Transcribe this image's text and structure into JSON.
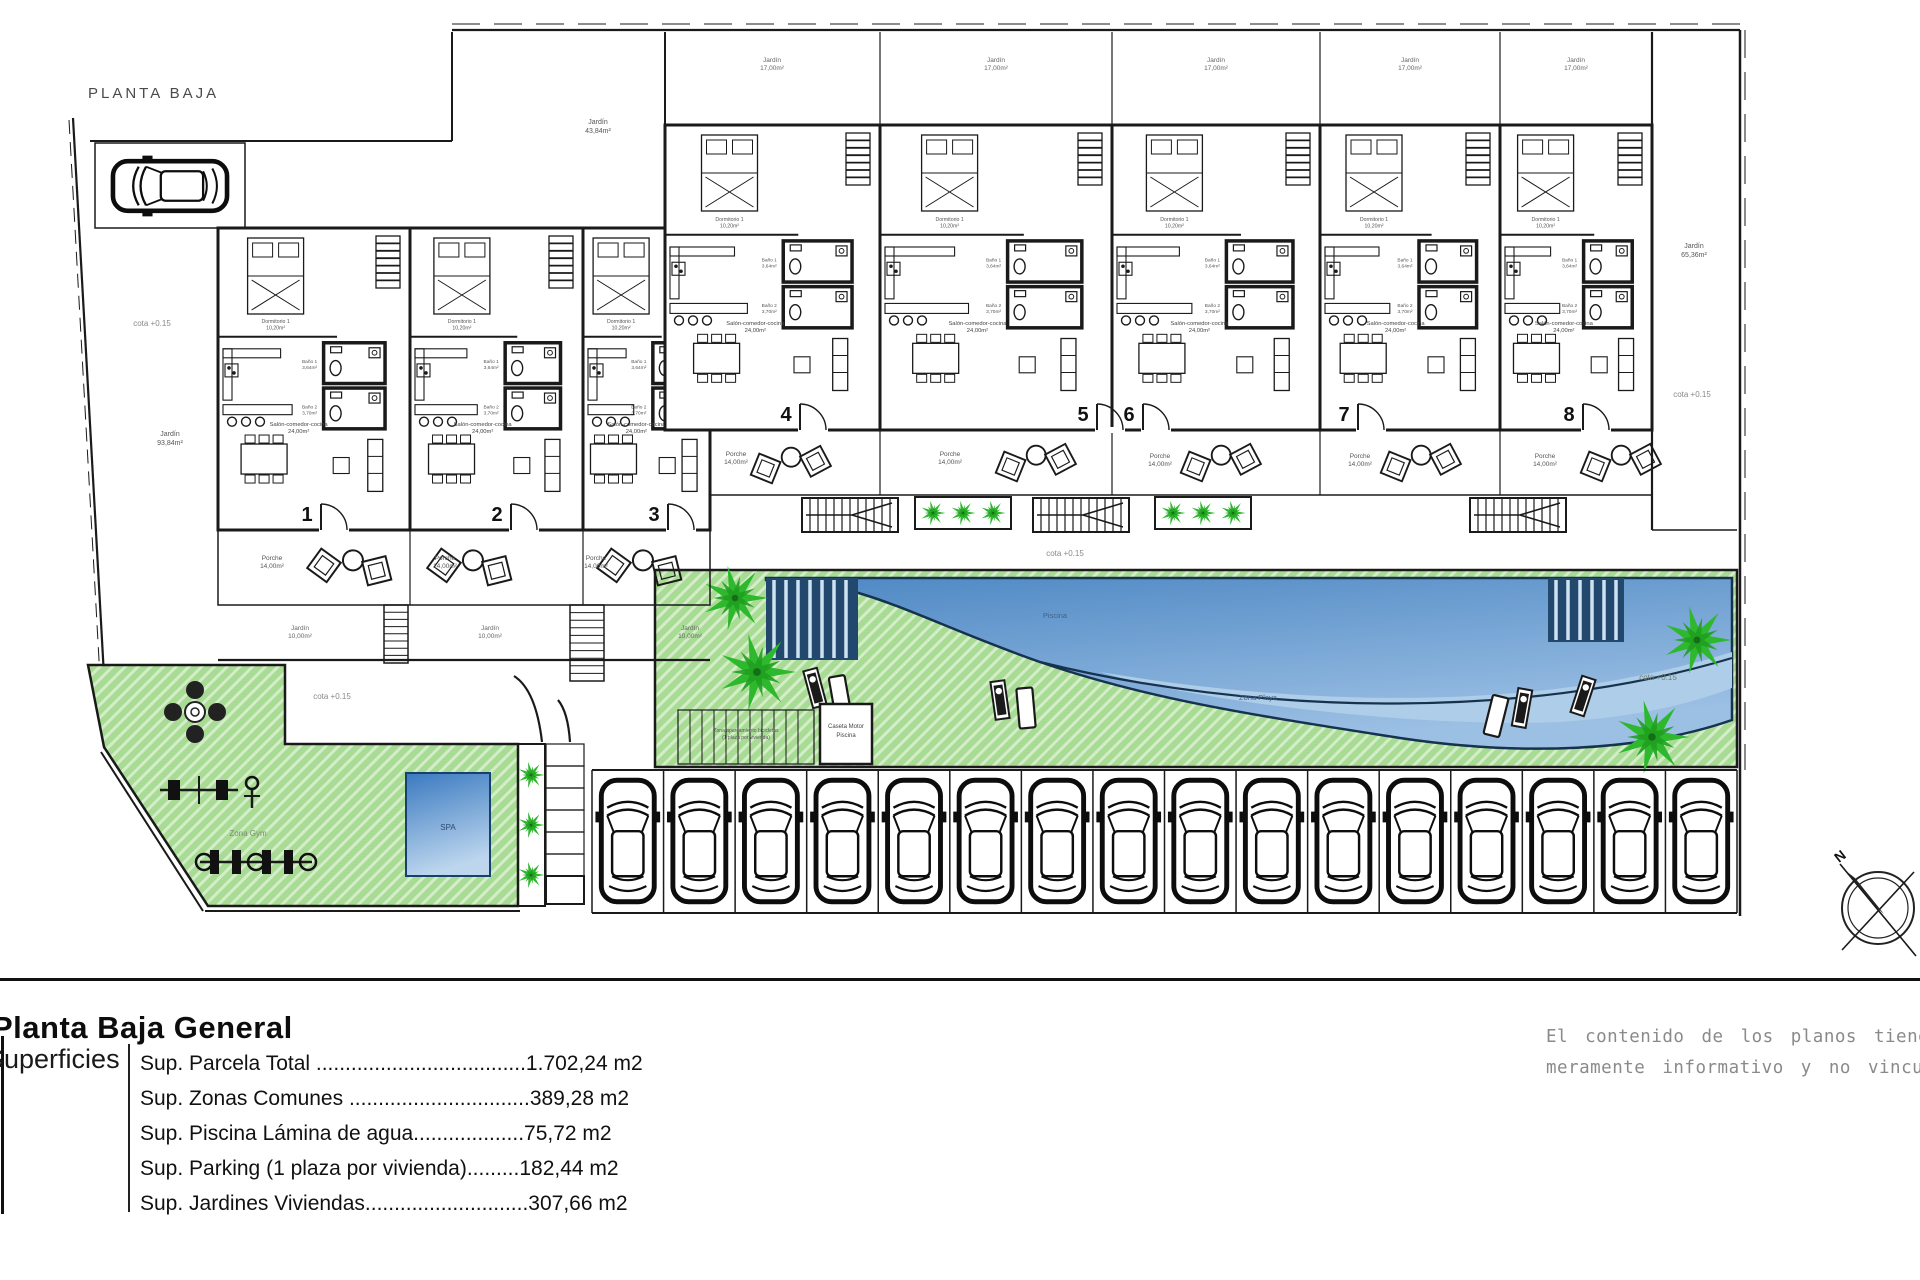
{
  "header": {
    "plan_label": "PLANTA BAJA"
  },
  "plan": {
    "unit_numbers": [
      "1",
      "2",
      "3",
      "4",
      "5",
      "6",
      "7",
      "8"
    ],
    "labels": {
      "cota": "cota +0.15",
      "jardin": "Jardín",
      "porche": "Porche",
      "dorm1": "Dormitorio 1",
      "dorm2": "Dormitorio 2",
      "bano1": "Baño 1",
      "bano2": "Baño 2",
      "salon": "Salón-comedor-cocina",
      "spa": "SPA",
      "zona_gym": "Zona Gym",
      "zona_playa": "Zona Playa",
      "piscina": "Piscina",
      "caseta_line1": "Caseta Motor",
      "caseta_line2": "Piscina",
      "bikes_line1": "Zona aparcamiento bicicletas",
      "bikes_line2": "(1 plaza por vivienda)",
      "north": "N"
    },
    "areas": {
      "jardin_top": "43,84m²",
      "jardin_left": "93,84m²",
      "jardin_right": "65,36m²",
      "jardin_small": "10,00m²",
      "jardin_unit": "17,00m²",
      "porche": "14,00m²",
      "dorm1": "10,20m²",
      "dorm2": "8,05m²",
      "bano1": "3,64m²",
      "bano2": "3,70m²",
      "salon": "24,00m²"
    }
  },
  "titleblock": {
    "title": "Planta Baja General",
    "section_label": "Superficies",
    "rows": [
      "Sup. Parcela Total ....................................1.702,24 m2",
      "Sup. Zonas Comunes ...............................389,28 m2",
      "Sup. Piscina Lámina de agua...................75,72 m2",
      "Sup. Parking (1 plaza por vivienda).........182,44 m2",
      "Sup. Jardines Viviendas............................307,66 m2"
    ]
  },
  "disclaimer": {
    "line1": "El contenido de los planos tiene valor",
    "line2": "meramente informativo y no vinculante"
  },
  "colors": {
    "lawn": "#a8db93",
    "hatch": "#ffffff",
    "palm": "#2eb82e",
    "palm_dark": "#1f9e1f",
    "pool_top": "#4e88c4",
    "pool_bottom": "#9cc0e4",
    "playa": "#aecde8",
    "deck": "#23486e",
    "spa_top": "#3a7ac0",
    "spa_bottom": "#bdd6ee",
    "ink": "#1a1a1a",
    "muted": "#8a8a8a"
  }
}
